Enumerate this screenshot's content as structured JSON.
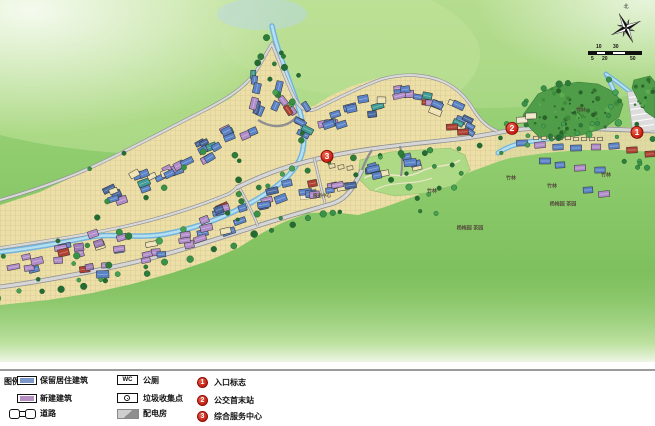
{
  "map": {
    "region_labels": [
      "竹林",
      "竹林",
      "竹林",
      "竹林",
      "竹林",
      "杨梅园 茶园",
      "杨梅园 茶园",
      "服务中心"
    ],
    "markers": [
      "1",
      "2",
      "3"
    ],
    "compass_label": "北",
    "scale": {
      "upper": [
        "10",
        "30"
      ],
      "lower": [
        "5",
        "20",
        "50"
      ]
    }
  },
  "legend": {
    "title": "图例",
    "items": [
      {
        "label": "保留居住建筑"
      },
      {
        "label": "新建建筑"
      },
      {
        "label": "道路"
      },
      {
        "label": "公厕",
        "icon_text": "WC"
      },
      {
        "label": "垃圾收集点"
      },
      {
        "label": "配电房"
      },
      {
        "label": "入口标志",
        "number": "1"
      },
      {
        "label": "公交首末站",
        "number": "2"
      },
      {
        "label": "综合服务中心",
        "number": "3"
      }
    ],
    "colors": {
      "retained_building": "#7b97c9",
      "new_building": "#b68fc2",
      "marker_red": "#c7231a"
    }
  }
}
